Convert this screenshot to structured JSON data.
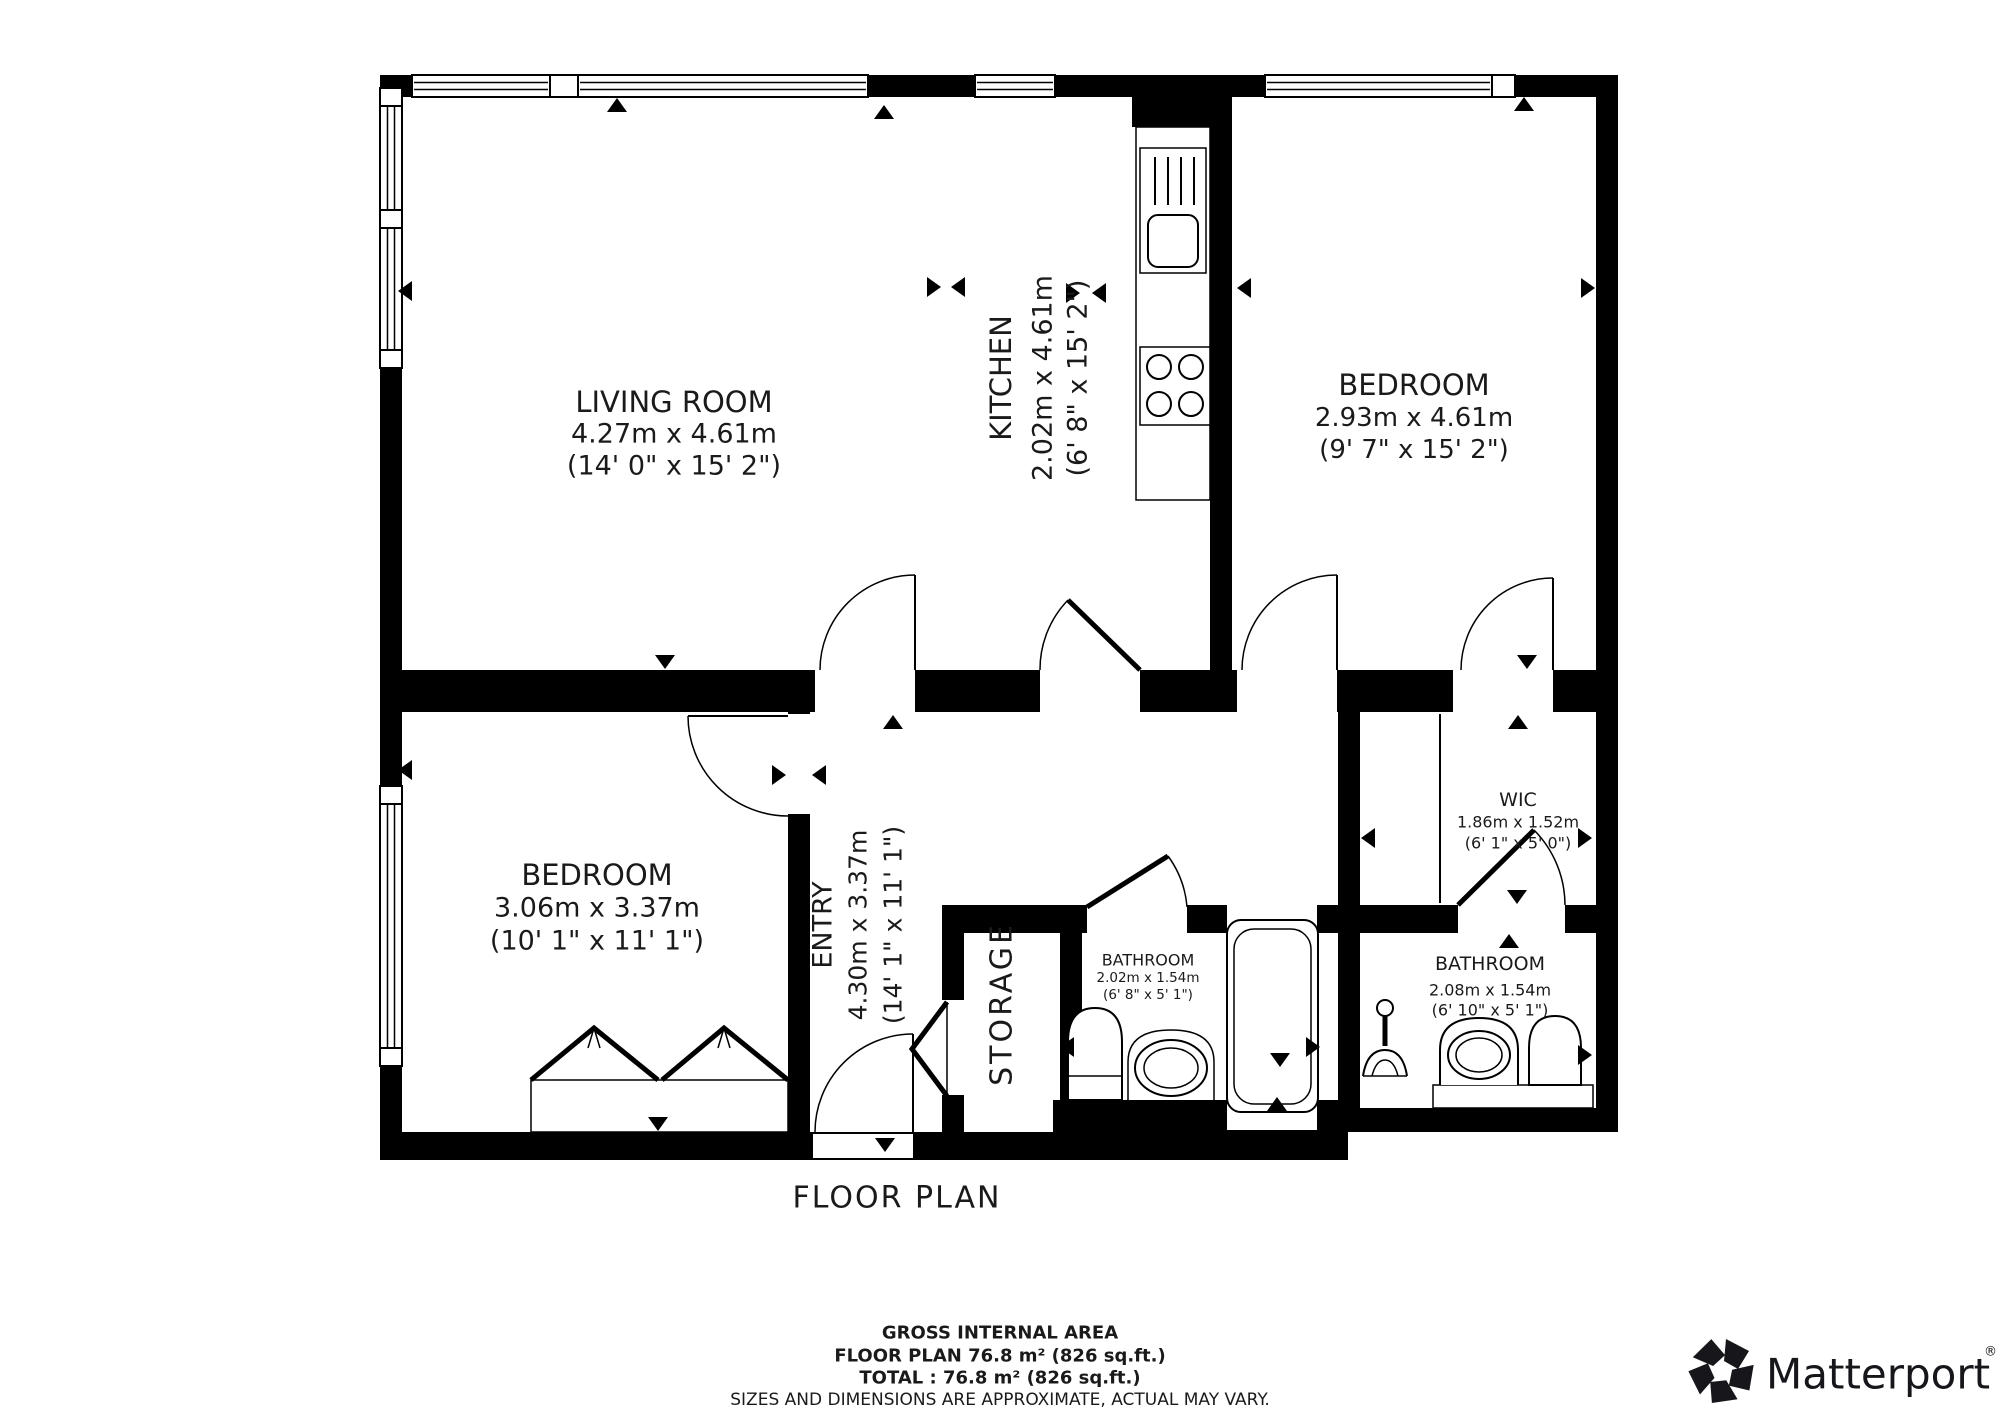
{
  "title": "FLOOR PLAN",
  "rooms": {
    "living_room": {
      "name": "LIVING ROOM",
      "metric": "4.27m x 4.61m",
      "imperial": "(14' 0\" x 15' 2\")"
    },
    "kitchen": {
      "name": "KITCHEN",
      "metric": "2.02m x 4.61m",
      "imperial": "(6' 8\" x 15' 2\")"
    },
    "bedroom_right": {
      "name": "BEDROOM",
      "metric": "2.93m x 4.61m",
      "imperial": "(9' 7\" x 15' 2\")"
    },
    "bedroom_left": {
      "name": "BEDROOM",
      "metric": "3.06m x 3.37m",
      "imperial": "(10' 1\" x 11' 1\")"
    },
    "entry": {
      "name": "ENTRY",
      "metric": "4.30m x 3.37m",
      "imperial": "(14' 1\" x 11' 1\")"
    },
    "storage": {
      "name": "STORAGE"
    },
    "wic": {
      "name": "WIC",
      "metric": "1.86m x 1.52m",
      "imperial": "(6' 1\" x 5' 0\")"
    },
    "bathroom_left": {
      "name": "BATHROOM",
      "metric": "2.02m x 1.54m",
      "imperial": "(6' 8\" x 5' 1\")"
    },
    "bathroom_right": {
      "name": "BATHROOM",
      "metric": "2.08m x 1.54m",
      "imperial": "(6' 10\" x 5' 1\")"
    }
  },
  "footer": {
    "line1": "GROSS INTERNAL AREA",
    "line2": "FLOOR PLAN 76.8 m² (826 sq.ft.)",
    "line3": "TOTAL :  76.8 m² (826 sq.ft.)",
    "disclaimer": "SIZES AND DIMENSIONS ARE APPROXIMATE, ACTUAL MAY VARY."
  },
  "brand": {
    "logo_text": "Matterport",
    "registered": "®"
  },
  "colors": {
    "wall": "#000000",
    "background": "#ffffff",
    "disclaimer_gray": "#8a8a8a"
  }
}
